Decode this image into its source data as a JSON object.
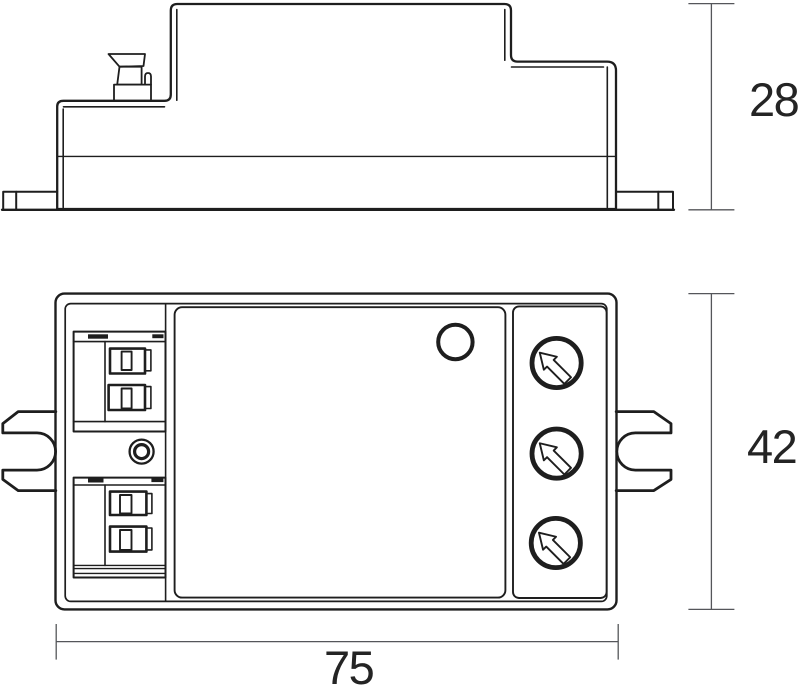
{
  "drawing_title": "Technical dimension drawing, two orthographic views of a compact module",
  "dimensions": {
    "side_height": "28",
    "front_height": "42",
    "width": "75"
  },
  "colors": {
    "line": "#1e1e1e",
    "dimension_line": "#55565a",
    "label_text": "#242424",
    "background": "#ffffff"
  }
}
